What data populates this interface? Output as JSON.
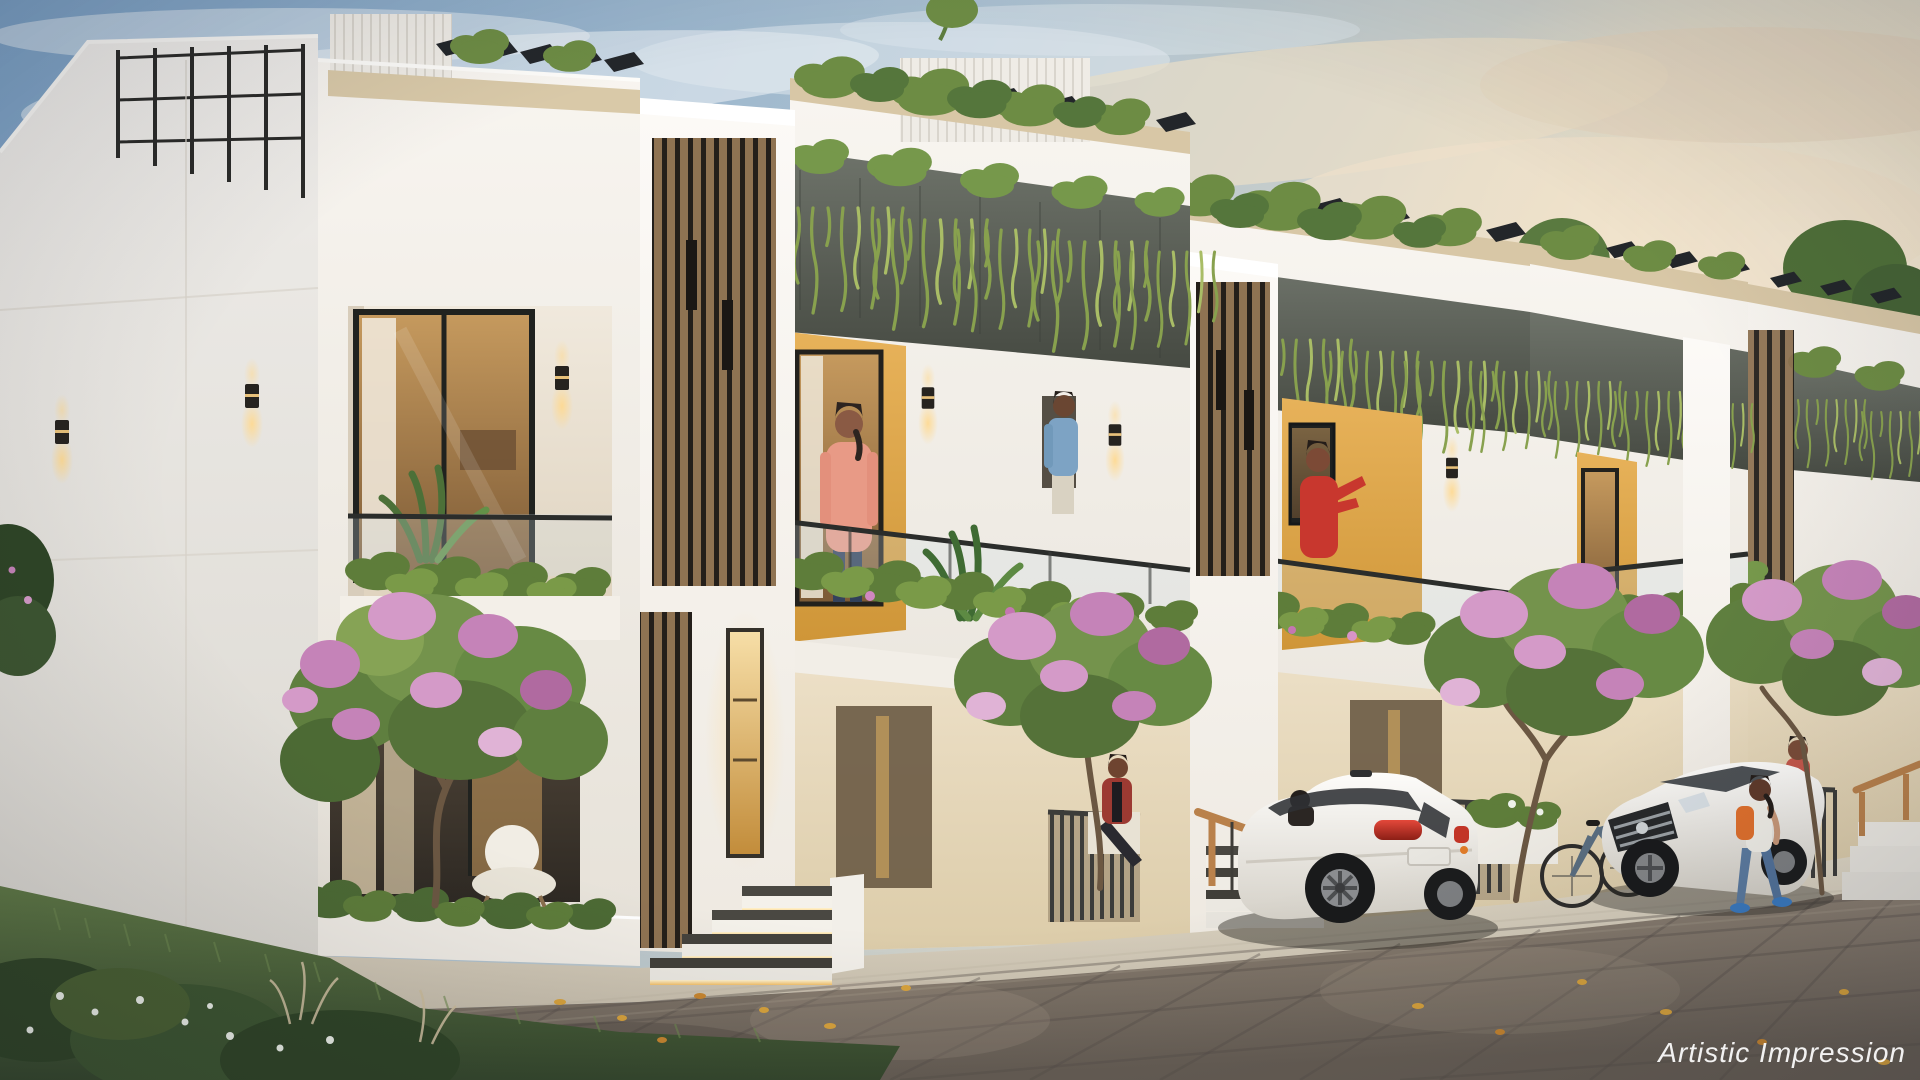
{
  "watermark": {
    "text": "Artistic Impression"
  },
  "scene": {
    "type": "architectural-rendering",
    "subject": "modern-row-townhouses-at-dusk"
  },
  "palette": {
    "sky_top": "#7ba1c6",
    "sky_warm": "#e9dfc9",
    "cloud_warm": "#eedfc8",
    "wall_white": "#f4f1ea",
    "wall_cream": "#e8dcc2",
    "accent_yellow": "#cf9638",
    "accent_yellow_light": "#e7b25a",
    "concrete_planter": "#565b52",
    "wood_slat": "#8f7352",
    "wood_dark_gap": "#241f1a",
    "pergola_dark": "#23262a",
    "foliage_green": "#74934c",
    "foliage_deep": "#4c6a34",
    "vine_green": "#88a14e",
    "blossom_pink": "#c583b8",
    "paver_gray": "#8d8276",
    "grass_green": "#55713f",
    "glow_warm": "#f7c86a",
    "car_white": "#f6f4ef",
    "taillight_red": "#c23527",
    "backpack_orange": "#e0702c",
    "handrail_wood": "#b9814b"
  }
}
